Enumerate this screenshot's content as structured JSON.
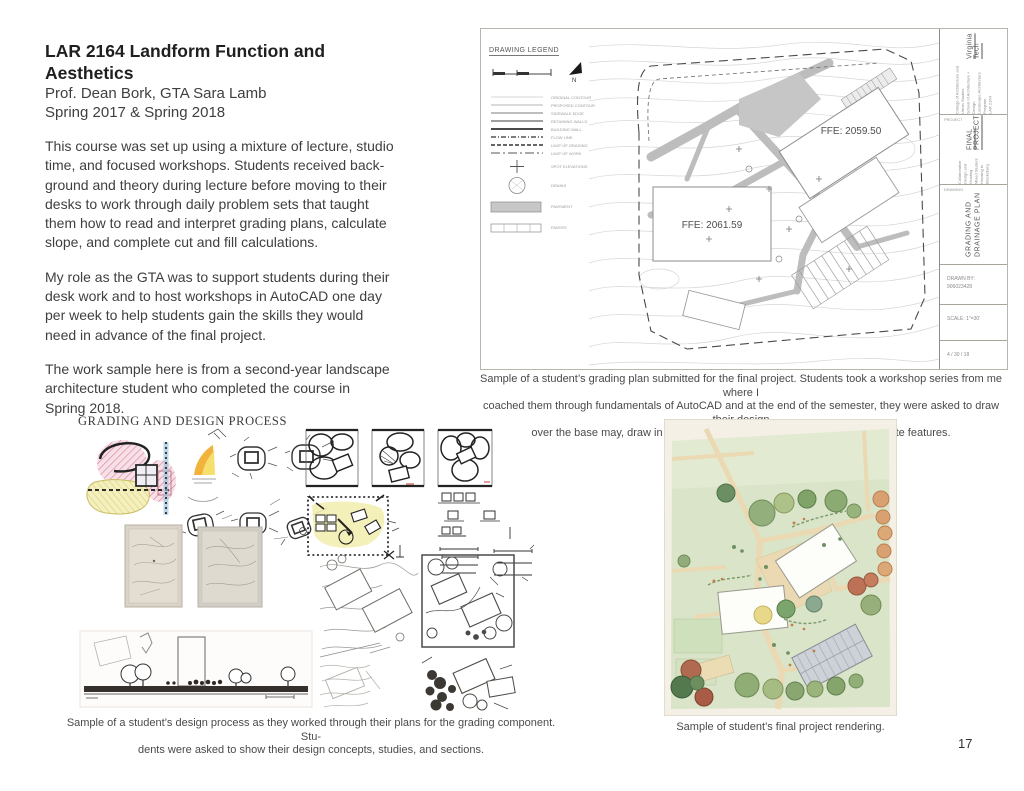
{
  "page": {
    "number": "17"
  },
  "header": {
    "title": "LAR 2164 Landform Function and Aesthetics",
    "instructor": "Prof. Dean Bork, GTA Sara Lamb",
    "terms": "Spring 2017 & Spring 2018"
  },
  "body_text": {
    "para1": "This course was set up using a mixture of lecture, studio\ntime, and focused workshops. Students received back-\nground and theory during lecture before moving to their\ndesks to work through daily problem sets that taught\nthem how to read and interpret grading plans, calculate\nslope, and complete cut and fill calculations.",
    "para2": "My role as the GTA was to support students during their\ndesk work and to host workshops in AutoCAD one day\nper week to help students gain the skills they would\nneed in advance of the final project.",
    "para3": "The work sample here is from a second-year landscape\narchitecture student who completed the course in\nSpring 2018."
  },
  "grading_plan": {
    "legend_title": "DRAWING LEGEND",
    "north_label": "N",
    "legend_items": [
      "ORIGINAL CONTOUR",
      "PROPOSED CONTOUR",
      "SIDEWALK EDGE",
      "RETAINING WALLS",
      "BUILDING WALL",
      "FLOW LINE",
      "LIMIT OF GRADING",
      "LIMIT OF WORK",
      "SPOT ELEVATIONS",
      "DRAINS",
      "PAVEMENT",
      "PAVERS"
    ],
    "ffe_label_1": "FFE:  2061.59",
    "ffe_label_2": "FFE:  2059.50",
    "title_block": {
      "school": "Virginia Tech",
      "school_sub": "College of Architecture and Urban Studies\nSchool of Architecture + Design\nLandscape Architecture Program\nLAR 2164",
      "project_label": "PROJECT",
      "project_title": "FINAL PROJECT",
      "project_sub": "Collaborative Design and Grading\nMixed Student Housing in Blacksburg",
      "drawing_label": "DRAWING",
      "drawing_title": "GRADING AND\nDRAINAGE PLAN",
      "drawn_by": "DRAWN BY:\n906023428",
      "scale": "SCALE: 1\"=30'",
      "date": "4 / 30 / 18"
    },
    "caption": "Sample of a student’s grading plan submitted for the final project. Students took a workshop series from me where I\ncoached them through fundamentals of AutoCAD and at the end of the semester, they were asked to draw their design\nover the base may, draw in proposed contours and spot elevations for all site features."
  },
  "design_process": {
    "heading": "GRADING AND DESIGN PROCESS",
    "caption": "Sample of a student’s design process as they worked through their plans for the grading component. Stu-\ndents were asked to show their design concepts, studies, and sections."
  },
  "rendering": {
    "caption": "Sample of student’s final project rendering."
  },
  "colors": {
    "body_text": "#3f3f3f",
    "caption_text": "#4a4a4a",
    "plan_gray": "#bdbdbd",
    "sketch_pink": "#dc8ba1",
    "sketch_yellow": "#efe7a4",
    "render_green": "#d9e4c8",
    "render_tan": "#ead9b2"
  }
}
